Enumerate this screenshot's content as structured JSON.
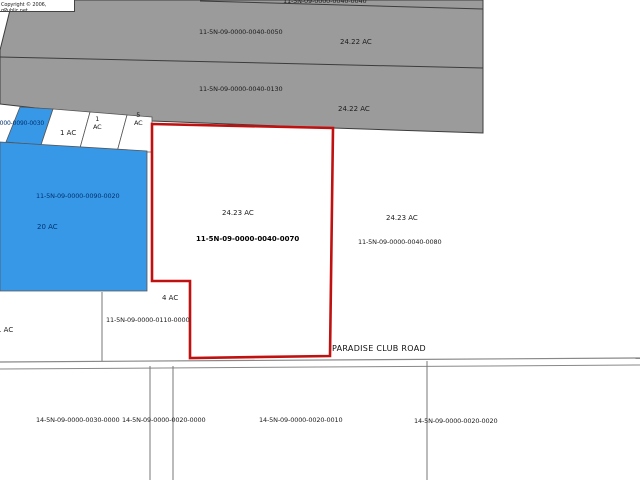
{
  "map": {
    "copyright": "Copyright © 2006, qPublic.net",
    "road_label": "PARADISE CLUB ROAD",
    "colors": {
      "selected_outline": "#c01010",
      "parcel_blue": "#3898e8",
      "no_data_gray": "#9b9b9b",
      "navy_label": "#00336e"
    }
  },
  "parcels": {
    "top_sliver": {
      "id": "11-5N-09-0000-0040-0040"
    },
    "north_strip": {
      "id": "11-5N-09-0000-0040-0050",
      "acres": "24.22 AC"
    },
    "mid_strip": {
      "id": "11-5N-09-0000-0040-0130",
      "acres": "24.22 AC"
    },
    "small_blue": {
      "id": "0000-0090-0030"
    },
    "one_ac_west": {
      "acres": "1 AC"
    },
    "one_ac_mid": {
      "acres": "1\nAC"
    },
    "five_ac": {
      "acres": "5\nAC"
    },
    "blue_main": {
      "id": "11-5N-09-0000-0090-0020",
      "acres": "20 AC"
    },
    "selected": {
      "id": "11-5N-09-0000-0040-0070",
      "acres": "24.23 AC"
    },
    "east": {
      "id": "11-5N-09-0000-0040-0080",
      "acres": "24.23 AC"
    },
    "four_ac": {
      "id": "11-5N-09-0000-0110-0000",
      "acres": "4 AC"
    },
    "one_ac_south": {
      "acres": "1 AC"
    },
    "south_a": {
      "id": "14-5N-09-0000-0030-0000"
    },
    "south_b": {
      "id": "14-5N-09-0000-0020-0000"
    },
    "south_c": {
      "id": "14-5N-09-0000-0020-0010"
    },
    "south_d": {
      "id": "14-5N-09-0000-0020-0020"
    }
  }
}
